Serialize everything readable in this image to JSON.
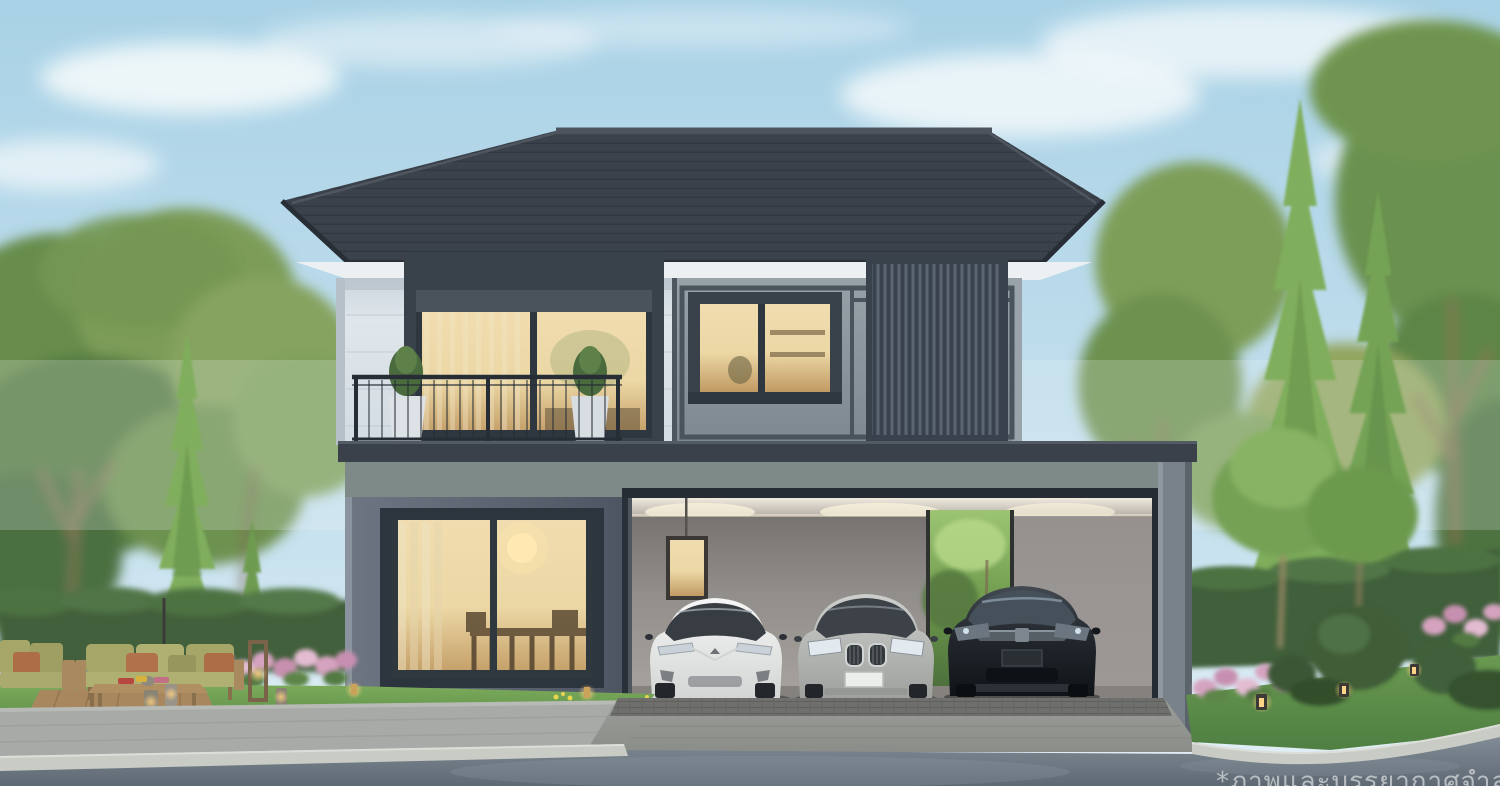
{
  "scene": {
    "type": "architectural-exterior-render",
    "watermark": "*ภาพและบรรยากาศจำลอง",
    "objects": [
      "two-story-modern-house",
      "hip-tile-roof",
      "balcony-with-railing",
      "sliding-glass-door",
      "upper-bedroom-window",
      "vertical-louver-panel",
      "dining-room-window",
      "carport",
      "white-suv",
      "silver-suv",
      "black-suv",
      "garden-hedge",
      "conifer-trees",
      "deciduous-trees",
      "pink-flower-beds",
      "topiary-balls",
      "outdoor-sofa-set",
      "coffee-table",
      "garden-lanterns",
      "lawn",
      "paver-driveway",
      "sidewalk",
      "curb",
      "asphalt-road",
      "sky-with-clouds"
    ]
  },
  "colors": {
    "sky_top": "#a9d2e6",
    "sky_bottom": "#e3f0f5",
    "cloud": "#f7fbfc",
    "roof": "#3b424b",
    "roof_edge": "#272e36",
    "soffit": "#edf0f2",
    "wall_white": "#dfe6ec",
    "wall_white_shade": "#b9c3cb",
    "panel_gray": "#8a949c",
    "frame_dark": "#39414b",
    "glass_warm": "#ecd8a5",
    "glass_warm_deep": "#c19a63",
    "parapet": "#3a414a",
    "stucco": "#7e8a88",
    "wall_dark": "#5a6470",
    "carport_wall": "#928e8b",
    "carport_ceiling": "#ddd7cd",
    "column": "#79828a",
    "car_white": "#eef0ef",
    "car_silver": "#b5b7b4",
    "car_black": "#1b2025",
    "grass": "#6da04f",
    "grass_dark": "#578748",
    "hedge": "#42603b",
    "tree_green": "#6f9750",
    "tree_olive": "#8da35c",
    "conifer": "#7fae5c",
    "flower_pink": "#d5a3c0",
    "wood": "#b08f63",
    "cushion_olive": "#a6a668",
    "pillow_rust": "#b1714a",
    "pavement": "#a7aaa6",
    "paver_dark": "#6f706d",
    "curb": "#c9cbc5",
    "road": "#6d7883",
    "lantern_glow": "#ffcf7e",
    "watermark": "#ffffff"
  }
}
